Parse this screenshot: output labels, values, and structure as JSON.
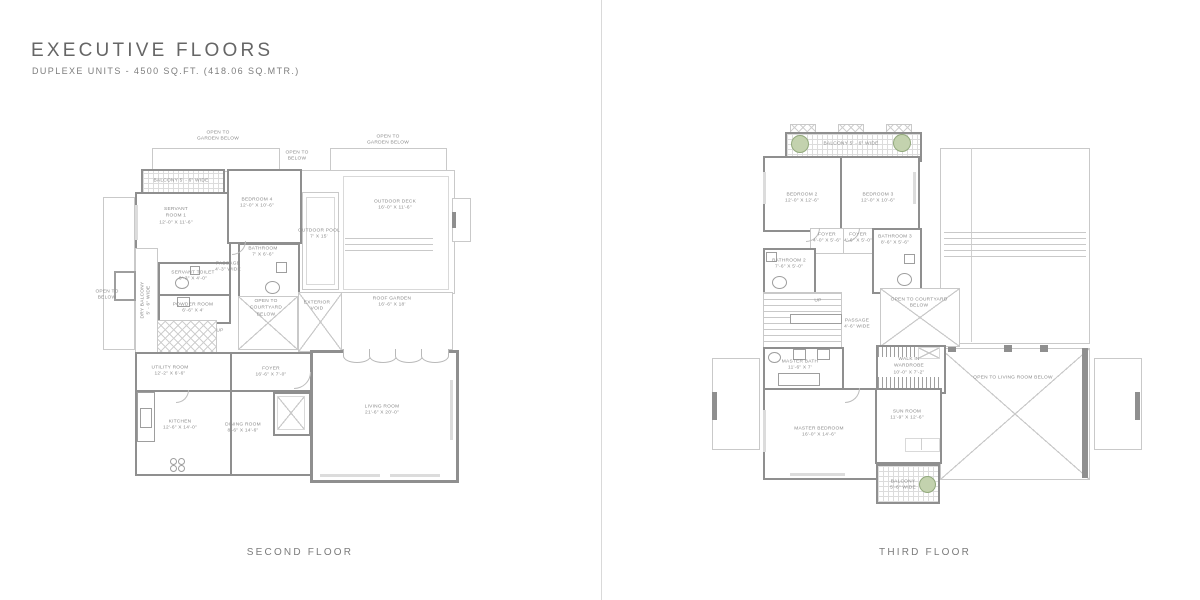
{
  "header": {
    "title": "EXECUTIVE FLOORS",
    "subtitle": "DUPLEXE UNITS - 4500 SQ.FT. (418.06 SQ.MTR.)"
  },
  "second_floor": {
    "caption": "SECOND FLOOR",
    "labels": {
      "open_garden_left": "OPEN TO\nGARDEN BELOW",
      "open_garden_right": "OPEN TO\nGARDEN BELOW",
      "open_below_top": "OPEN TO\nBELOW",
      "open_below_left": "OPEN TO\nBELOW",
      "balcony": "BALCONY 5' - 6\" WIDE",
      "dry_balcony": "DRY BALCONY\n5' - 6\" WIDE",
      "servant_room": "SERVANT\nROOM 1\n12'-0\" X 11'-6\"",
      "bedroom4": "BEDROOM 4\n12'-0\" X 10'-6\"",
      "bathroom": "BATHROOM\n7' X 6'-6\"",
      "passage": "PASSAGE\n4'-3\" WIDE",
      "servant_toilet": "SERVANT TOILET\n6'-3\" X 4'-0\"",
      "powder_room": "POWDER ROOM\n6'-6\" X 4'",
      "up": "UP",
      "open_courtyard": "OPEN TO\nCOURTYARD\nBELOW",
      "exterior_void": "EXTERIOR\nVOID",
      "outdoor_pool": "OUTDOOR POOL\n7' X 15'",
      "outdoor_deck": "OUTDOOR DECK\n16'-0\" X 11'-6\"",
      "roof_garden": "ROOF GARDEN\n16'-6\" X 18'",
      "utility_room": "UTILITY ROOM\n12'-2\" X 6'-6\"",
      "foyer": "FOYER\n16'-6\" X 7'-0\"",
      "kitchen": "KITCHEN\n12'-6\" X 14'-0\"",
      "dining_room": "DINING ROOM\n8'-6\" X 14'-6\"",
      "living_room": "LIVING ROOM\n21'-6\" X 20'-0\""
    }
  },
  "third_floor": {
    "caption": "THIRD FLOOR",
    "labels": {
      "balcony_top": "BALCONY 5' - 6\" WIDE",
      "bedroom2": "BEDROOM 2\n12'-0\" X 12'-6\"",
      "bedroom3": "BEDROOM 3\n12'-0\" X 10'-6\"",
      "foyer_left": "FOYER\n4'-0\" X 5'-6\"",
      "foyer_right": "FOYER\n4'-6\" X 5'-0\"",
      "bathroom3": "BATHROOM 3\n8'-6\" X 5'-6\"",
      "bathroom2": "BATHROOM 2\n7'-6\" X 5'-0\"",
      "up": "UP",
      "passage": "PASSAGE\n4'-6\" WIDE",
      "open_courtyard": "OPEN TO COURTYARD\nBELOW",
      "master_bath": "MASTER BATH\n11'-6\" X 7'",
      "walk_in_wardrobe": "WALK IN\nWARDROBE\n10'-0\" X 7'-2\"",
      "master_bedroom": "MASTER BEDROOM\n16'-0\" X 14'-6\"",
      "sun_room": "SUN ROOM\n11'-9\" X 12'-6\"",
      "open_living": "OPEN TO LIVING ROOM BELOW",
      "balcony_bottom": "BALCONY\n5'-6\" WIDE"
    }
  }
}
